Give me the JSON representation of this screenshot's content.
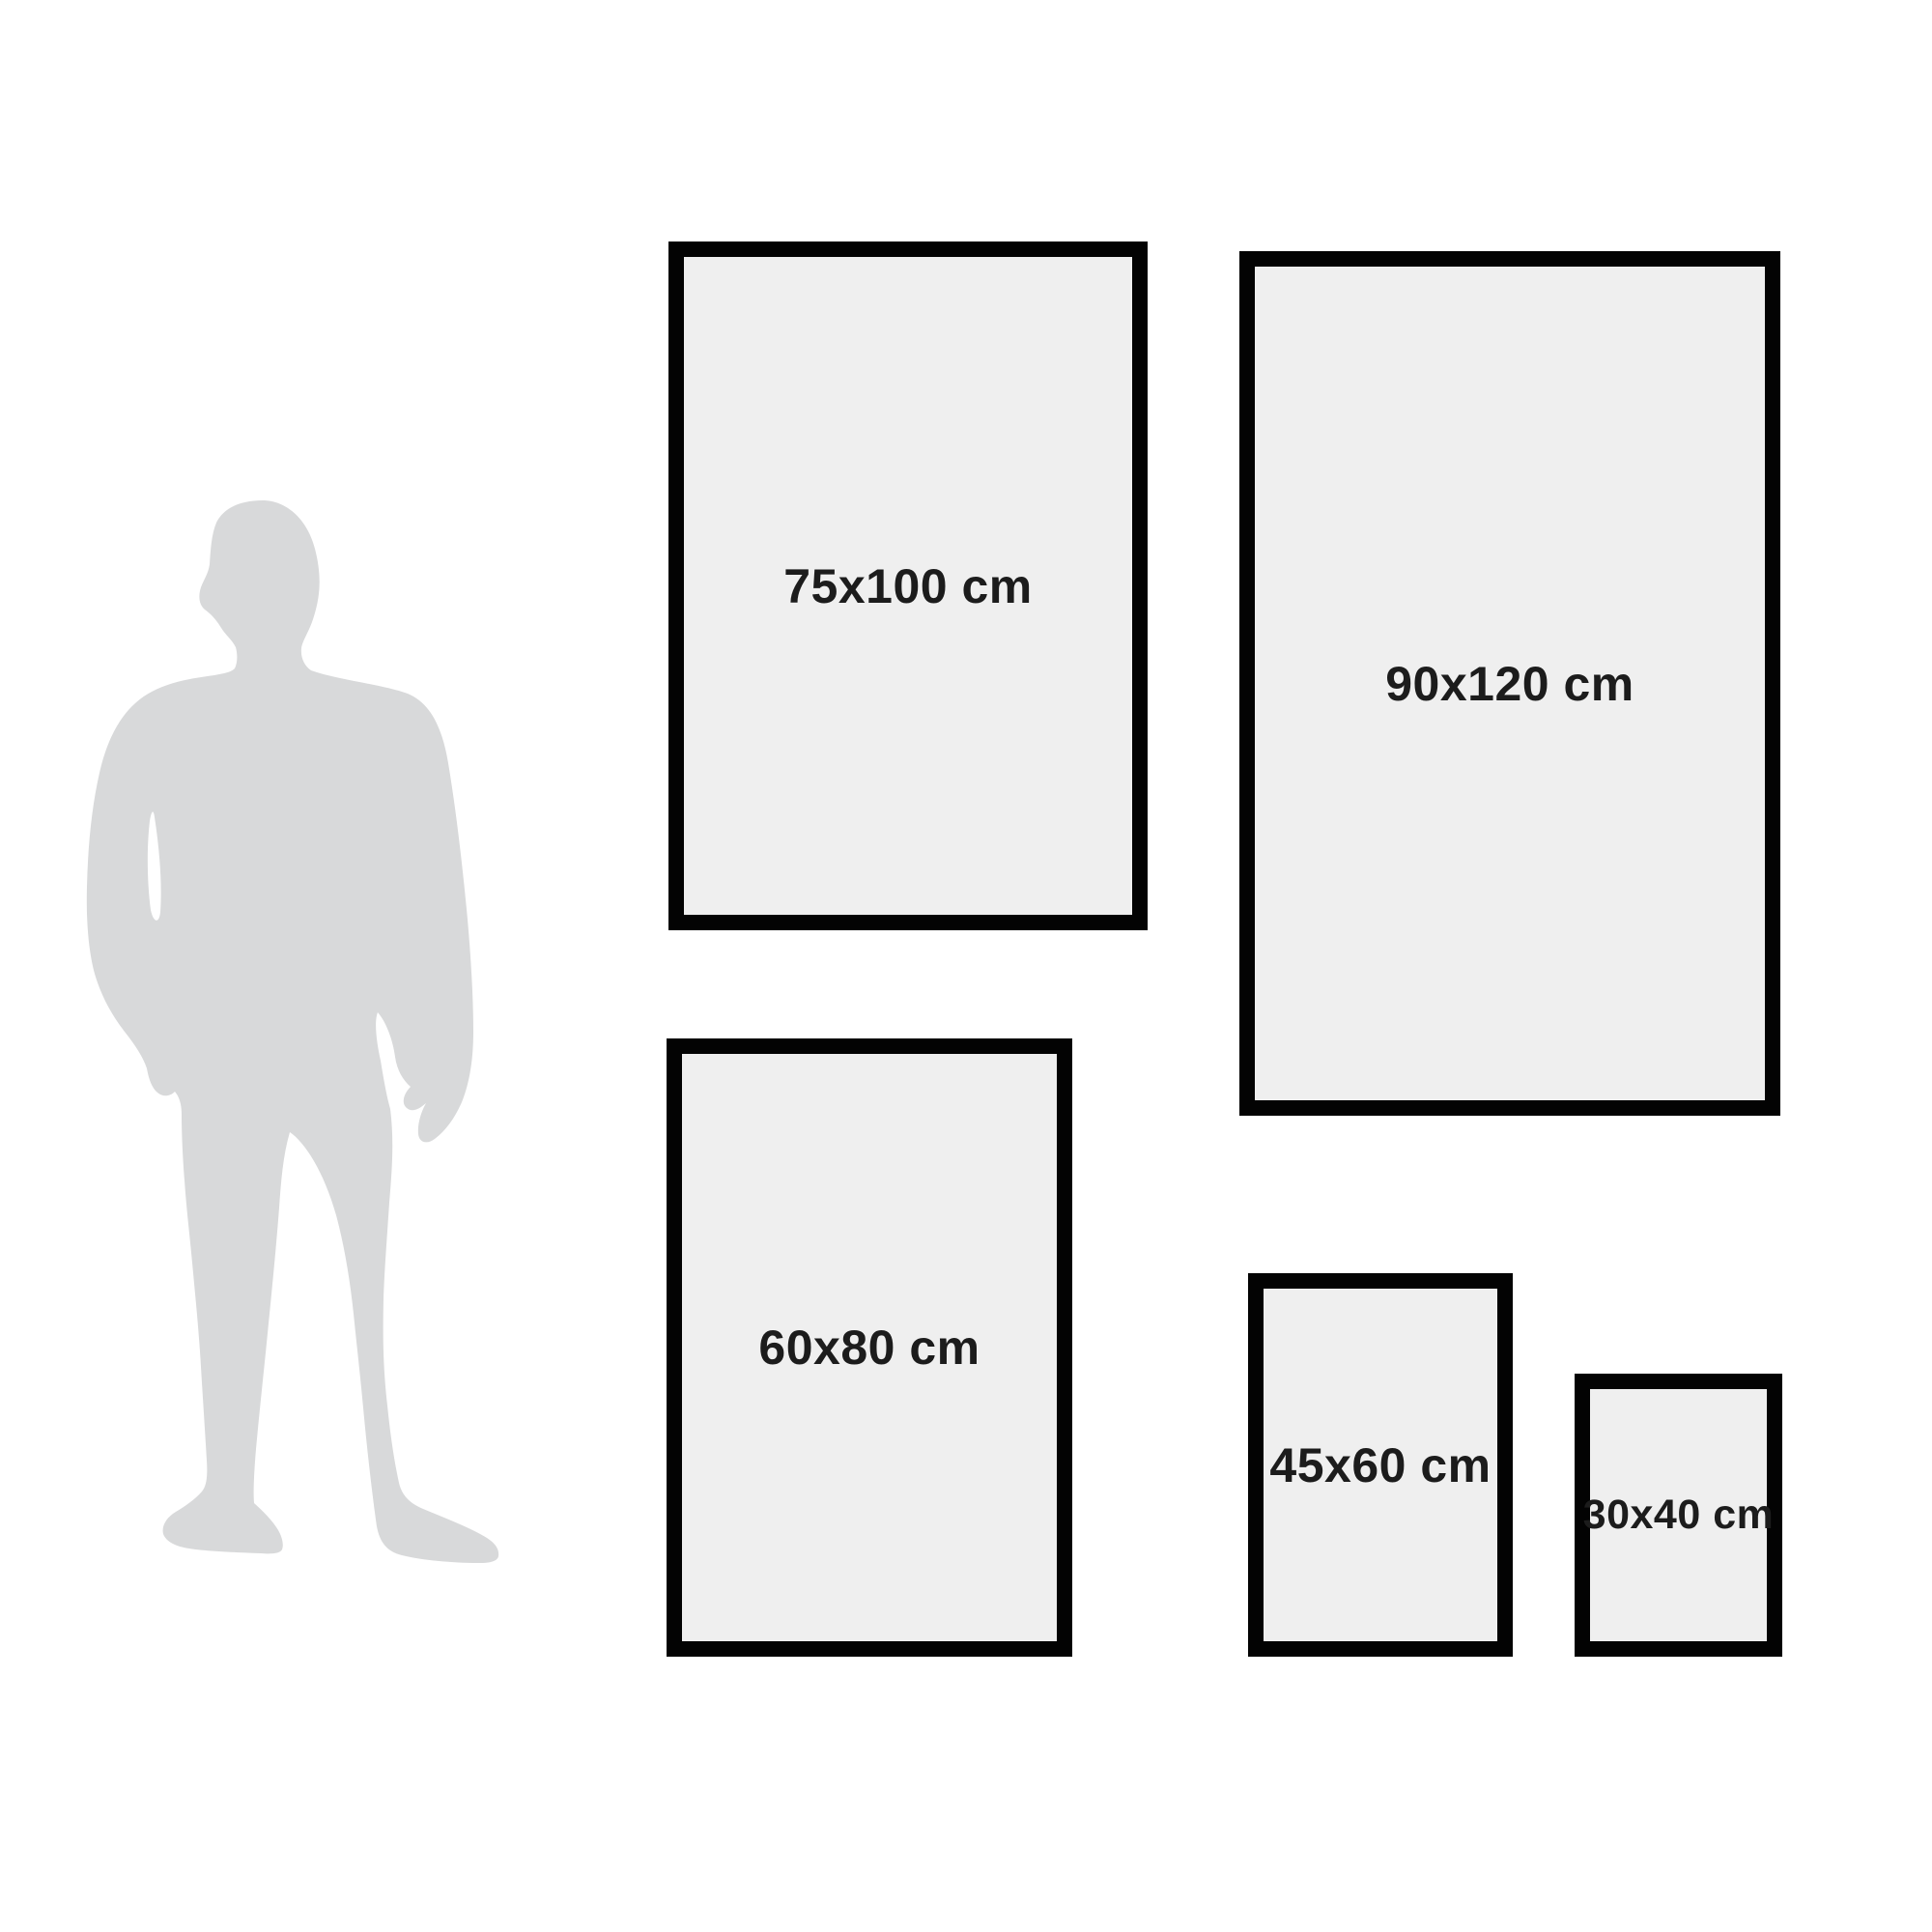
{
  "sizes": [
    {
      "label": "75x100 cm"
    },
    {
      "label": "90x120 cm"
    },
    {
      "label": "60x80 cm"
    },
    {
      "label": "45x60 cm"
    },
    {
      "label": "30x40 cm"
    }
  ],
  "silhouette": {
    "icon": "man-silhouette-icon"
  },
  "colors": {
    "background": "#ffffff",
    "frame_border": "#030303",
    "frame_fill": "#efefef",
    "silhouette_fill": "#d8d9da",
    "label_text": "#1c1c1c"
  }
}
